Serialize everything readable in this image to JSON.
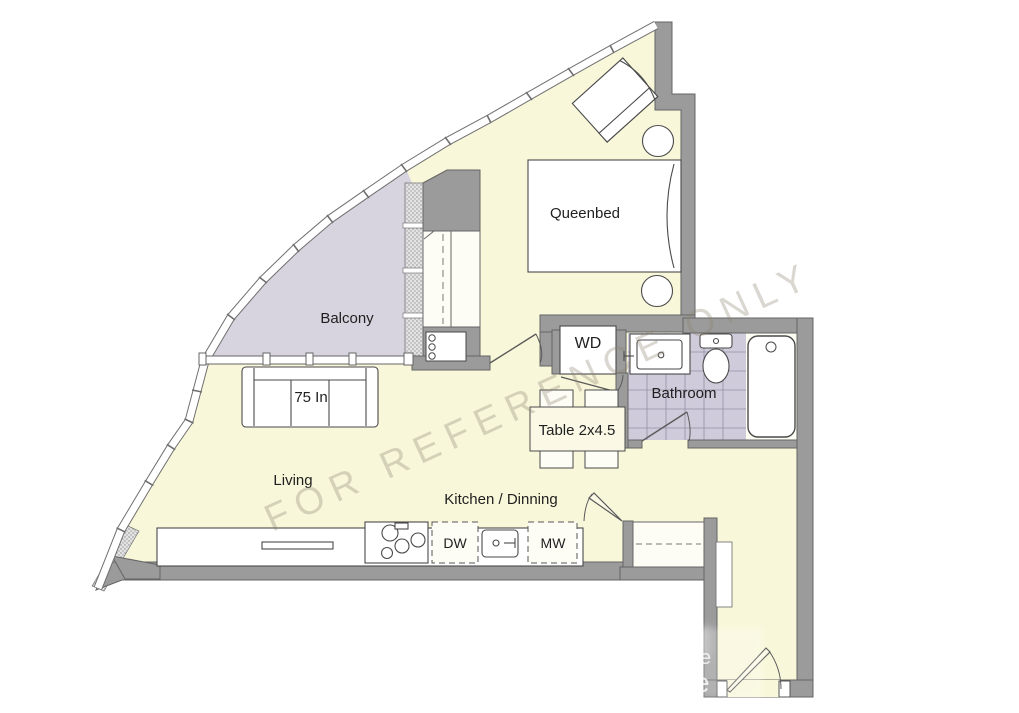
{
  "floor_plan": {
    "watermark": "FOR REFERENCE ONLY",
    "watermark_small_1": "e",
    "watermark_small_2": "e",
    "labels": {
      "queen_bed": "Queenbed",
      "balcony": "Balcony",
      "sofa": "75 In",
      "living": "Living",
      "table": "Table 2x4.5",
      "kitchen_dining": "Kitchen / Dinning",
      "bathroom": "Bathroom",
      "washer_dryer": "WD",
      "dishwasher": "DW",
      "microwave": "MW"
    },
    "colors": {
      "interior": "#f9f7da",
      "balcony": "#d8d4df",
      "wall": "#9b9b9b",
      "bathroom_tile": "#cfcbdb",
      "watermark_text": "#8d8472"
    }
  }
}
